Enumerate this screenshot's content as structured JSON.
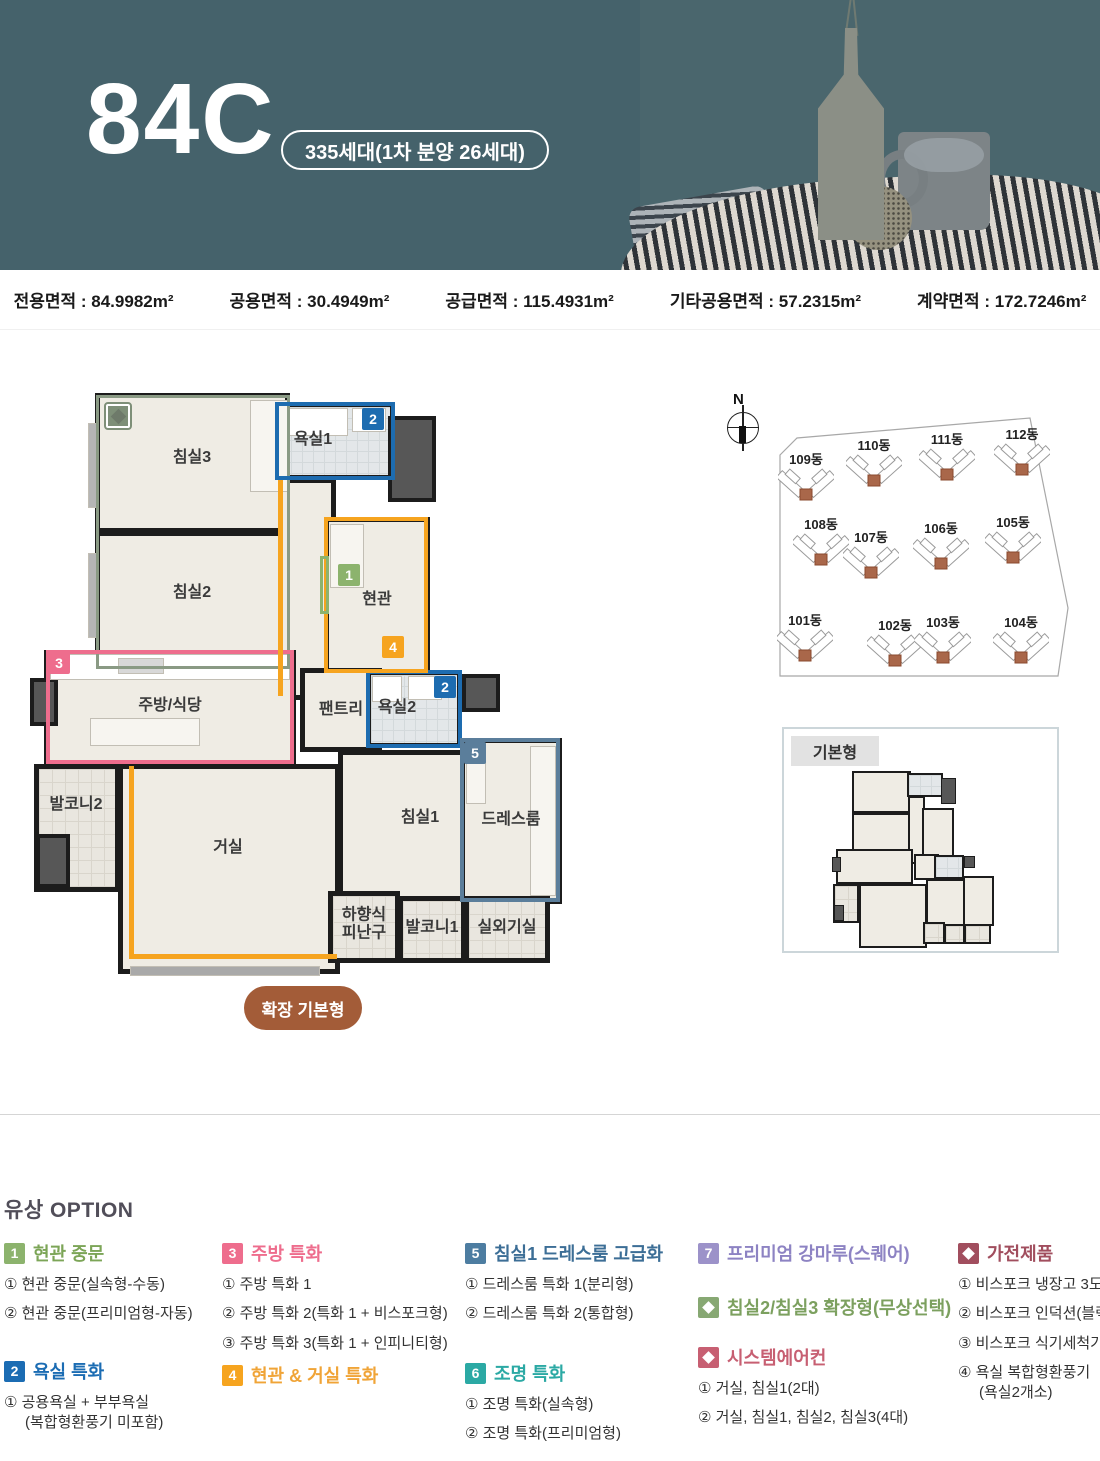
{
  "header": {
    "unit_type": "84C",
    "badge": "335세대(1차 분양 26세대)",
    "bg_color": "#45626b"
  },
  "area_bar": {
    "items": [
      {
        "label": "전용면적",
        "value": "84.9982m²"
      },
      {
        "label": "공용면적",
        "value": "30.4949m²"
      },
      {
        "label": "공급면적",
        "value": "115.4931m²"
      },
      {
        "label": "기타공용면적",
        "value": "57.2315m²"
      },
      {
        "label": "계약면적",
        "value": "172.7246m²"
      }
    ]
  },
  "floor_plan": {
    "expand_button": "확장 기본형",
    "wall_color": "#1c1c1c",
    "floor_color": "#efece4",
    "rooms": [
      {
        "key": "bedroom3",
        "x": 65,
        "y": 5,
        "w": 195,
        "h": 140,
        "type": "floor"
      },
      {
        "key": "bath1",
        "x": 245,
        "y": 14,
        "w": 120,
        "h": 78,
        "type": "bath"
      },
      {
        "key": "bedroom2",
        "x": 65,
        "y": 143,
        "w": 195,
        "h": 137,
        "type": "floor"
      },
      {
        "key": "corridor",
        "x": 248,
        "y": 90,
        "w": 58,
        "h": 222,
        "type": "floor"
      },
      {
        "key": "entrance",
        "x": 294,
        "y": 129,
        "w": 106,
        "h": 158,
        "type": "floor"
      },
      {
        "key": "kitchen",
        "x": 14,
        "y": 262,
        "w": 252,
        "h": 116,
        "type": "floor"
      },
      {
        "key": "pantry",
        "x": 270,
        "y": 280,
        "w": 82,
        "h": 84,
        "type": "floor"
      },
      {
        "key": "bath2",
        "x": 336,
        "y": 282,
        "w": 96,
        "h": 78,
        "type": "bath"
      },
      {
        "key": "balcony2",
        "x": 4,
        "y": 376,
        "w": 86,
        "h": 128,
        "type": "tile"
      },
      {
        "key": "living",
        "x": 88,
        "y": 376,
        "w": 222,
        "h": 210,
        "type": "floor"
      },
      {
        "key": "bedroom1",
        "x": 308,
        "y": 362,
        "w": 164,
        "h": 167,
        "type": "floor"
      },
      {
        "key": "dressroom",
        "x": 430,
        "y": 350,
        "w": 102,
        "h": 166,
        "type": "floor"
      },
      {
        "key": "escape",
        "x": 298,
        "y": 503,
        "w": 72,
        "h": 72,
        "type": "tile"
      },
      {
        "key": "balcony1",
        "x": 368,
        "y": 508,
        "w": 68,
        "h": 67,
        "type": "tile"
      },
      {
        "key": "outdoor",
        "x": 434,
        "y": 508,
        "w": 86,
        "h": 67,
        "type": "tile"
      }
    ],
    "dark_blocks": [
      {
        "x": 358,
        "y": 28,
        "w": 48,
        "h": 86
      },
      {
        "x": 432,
        "y": 286,
        "w": 38,
        "h": 38
      },
      {
        "x": 0,
        "y": 290,
        "w": 28,
        "h": 48
      },
      {
        "x": 6,
        "y": 446,
        "w": 34,
        "h": 54
      }
    ],
    "fixtures": [
      {
        "x": 20,
        "y": 266,
        "w": 240,
        "h": 26,
        "c": "#ffffff"
      },
      {
        "x": 88,
        "y": 270,
        "w": 46,
        "h": 16,
        "c": "#d8d8d8"
      },
      {
        "x": 60,
        "y": 330,
        "w": 110,
        "h": 28,
        "c": "#f7f5f0"
      },
      {
        "x": 252,
        "y": 20,
        "w": 66,
        "h": 28,
        "c": "#ffffff"
      },
      {
        "x": 322,
        "y": 20,
        "w": 34,
        "h": 24,
        "c": "#ffffff"
      },
      {
        "x": 342,
        "y": 288,
        "w": 30,
        "h": 26,
        "c": "#ffffff"
      },
      {
        "x": 378,
        "y": 288,
        "w": 34,
        "h": 24,
        "c": "#ffffff"
      },
      {
        "x": 220,
        "y": 12,
        "w": 38,
        "h": 92,
        "c": "#f7f5f0"
      },
      {
        "x": 500,
        "y": 358,
        "w": 26,
        "h": 150,
        "c": "#f7f5f0"
      },
      {
        "x": 436,
        "y": 356,
        "w": 20,
        "h": 60,
        "c": "#f7f5f0"
      },
      {
        "x": 300,
        "y": 136,
        "w": 34,
        "h": 64,
        "c": "#f7f5f0"
      },
      {
        "x": 58,
        "y": 35,
        "w": 9,
        "h": 85,
        "c": "#b5b5b5"
      },
      {
        "x": 58,
        "y": 165,
        "w": 9,
        "h": 85,
        "c": "#b5b5b5"
      },
      {
        "x": 100,
        "y": 578,
        "w": 190,
        "h": 10,
        "c": "#a9a9a9"
      }
    ],
    "overlays": [
      {
        "x": 66,
        "y": 7,
        "w": 194,
        "h": 274,
        "color": "#8a9a84",
        "bw": 3
      },
      {
        "x": 245,
        "y": 14,
        "w": 120,
        "h": 78,
        "color": "#1d6cb0",
        "bw": 4
      },
      {
        "x": 336,
        "y": 282,
        "w": 96,
        "h": 78,
        "color": "#1d6cb0",
        "bw": 4
      },
      {
        "x": 16,
        "y": 262,
        "w": 248,
        "h": 114,
        "color": "#ee6d8d",
        "bw": 4
      },
      {
        "x": 294,
        "y": 129,
        "w": 104,
        "h": 156,
        "color": "#f6a41f",
        "bw": 4
      },
      {
        "x": 430,
        "y": 350,
        "w": 100,
        "h": 164,
        "color": "#5b7e9b",
        "bw": 4
      },
      {
        "x": 290,
        "y": 168,
        "w": 9,
        "h": 58,
        "color": "#8db36e",
        "bw": 3
      }
    ],
    "orange_lines": [
      {
        "x": 248,
        "y": 92,
        "w": 5,
        "h": 216
      },
      {
        "x": 99,
        "y": 378,
        "w": 5,
        "h": 192
      },
      {
        "x": 99,
        "y": 566,
        "w": 208,
        "h": 5
      }
    ],
    "labels": [
      {
        "text": "침실3",
        "x": 162,
        "y": 70
      },
      {
        "text": "욕실1",
        "x": 283,
        "y": 52
      },
      {
        "text": "침실2",
        "x": 162,
        "y": 205
      },
      {
        "text": "현관",
        "x": 347,
        "y": 212
      },
      {
        "text": "주방/식당",
        "x": 140,
        "y": 318
      },
      {
        "text": "팬트리",
        "x": 311,
        "y": 322
      },
      {
        "text": "욕실2",
        "x": 367,
        "y": 320
      },
      {
        "text": "발코니2",
        "x": 46,
        "y": 417
      },
      {
        "text": "거실",
        "x": 198,
        "y": 460
      },
      {
        "text": "침실1",
        "x": 390,
        "y": 430
      },
      {
        "text": "드레스룸",
        "x": 481,
        "y": 432
      },
      {
        "text": "하향식\n피난구",
        "x": 334,
        "y": 537
      },
      {
        "text": "발코니1",
        "x": 402,
        "y": 540
      },
      {
        "text": "실외기실",
        "x": 477,
        "y": 540
      }
    ],
    "badges": [
      {
        "n": "2",
        "x": 332,
        "y": 20,
        "color": "#1d6cb0"
      },
      {
        "n": "1",
        "x": 308,
        "y": 176,
        "color": "#8cb36d"
      },
      {
        "n": "4",
        "x": 352,
        "y": 248,
        "color": "#f6a41f"
      },
      {
        "n": "3",
        "x": 18,
        "y": 264,
        "color": "#ee6d8d"
      },
      {
        "n": "2",
        "x": 404,
        "y": 288,
        "color": "#1d6cb0"
      },
      {
        "n": "5",
        "x": 434,
        "y": 354,
        "color": "#5b7e9b"
      }
    ],
    "marker": {
      "x": 76,
      "y": 16,
      "size": 24,
      "color": "#7e8f78"
    }
  },
  "site_plan": {
    "compass": "N",
    "boundary_points": "80,62 97,45 330,25 368,215 358,283 80,283",
    "unit_color": "#a9674a",
    "buildings": [
      {
        "name": "109동",
        "x": 106,
        "y": 56
      },
      {
        "name": "110동",
        "x": 174,
        "y": 42
      },
      {
        "name": "111동",
        "x": 247,
        "y": 36
      },
      {
        "name": "112동",
        "x": 322,
        "y": 31
      },
      {
        "name": "108동",
        "x": 121,
        "y": 121
      },
      {
        "name": "107동",
        "x": 171,
        "y": 134
      },
      {
        "name": "106동",
        "x": 241,
        "y": 125
      },
      {
        "name": "105동",
        "x": 313,
        "y": 119
      },
      {
        "name": "101동",
        "x": 105,
        "y": 217
      },
      {
        "name": "102동",
        "x": 195,
        "y": 222
      },
      {
        "name": "103동",
        "x": 243,
        "y": 219
      },
      {
        "name": "104동",
        "x": 321,
        "y": 219
      }
    ]
  },
  "basic_plan": {
    "label": "기본형"
  },
  "options": {
    "title": "유상 OPTION",
    "columns": [
      {
        "left": 4,
        "sections": [
          {
            "top": 0,
            "badge": "1",
            "badge_type": "number",
            "color": "#8cb36d",
            "title_color": "#7ca557",
            "title": "현관 중문",
            "items": [
              {
                "text": "① 현관 중문(실속형-수동)"
              },
              {
                "text": "② 현관 중문(프리미엄형-자동)"
              }
            ]
          },
          {
            "top": 118,
            "badge": "2",
            "badge_type": "number",
            "color": "#1b6cb3",
            "title_color": "#1b6cb3",
            "title": "욕실 특화",
            "items": [
              {
                "text": "① 공용욕실 + 부부욕실",
                "sub": "(복합형환풍기 미포함)"
              }
            ]
          }
        ]
      },
      {
        "left": 222,
        "sections": [
          {
            "top": 0,
            "badge": "3",
            "badge_type": "number",
            "color": "#ee6d8d",
            "title_color": "#ee6d8d",
            "title": "주방 특화",
            "items": [
              {
                "text": "① 주방 특화 1"
              },
              {
                "text": "② 주방 특화 2(특화 1 + 비스포크형)"
              },
              {
                "text": "③ 주방 특화 3(특화 1 + 인피니티형)"
              }
            ]
          },
          {
            "top": 122,
            "badge": "4",
            "badge_type": "number",
            "color": "#f6a41f",
            "title_color": "#f0a437",
            "title": "현관 & 거실 특화",
            "items": []
          }
        ]
      },
      {
        "left": 465,
        "sections": [
          {
            "top": 0,
            "badge": "5",
            "badge_type": "number",
            "color": "#4d7da1",
            "title_color": "#3c6e96",
            "title": "침실1 드레스룸 고급화",
            "items": [
              {
                "text": "① 드레스룸 특화 1(분리형)"
              },
              {
                "text": "② 드레스룸 특화 2(통합형)"
              }
            ]
          },
          {
            "top": 120,
            "badge": "6",
            "badge_type": "number",
            "color": "#2ba9a4",
            "title_color": "#2ba9a4",
            "title": "조명 특화",
            "items": [
              {
                "text": "① 조명 특화(실속형)"
              },
              {
                "text": "② 조명 특화(프리미엄형)"
              }
            ]
          }
        ]
      },
      {
        "left": 698,
        "sections": [
          {
            "top": 0,
            "badge": "7",
            "badge_type": "number",
            "color": "#9c92c9",
            "title_color": "#8d83c3",
            "title": "프리미엄 강마루(스퀘어)",
            "items": []
          },
          {
            "top": 54,
            "badge": "",
            "badge_type": "diamond",
            "color": "#87a873",
            "title_color": "#7ca05f",
            "title": "침실2/침실3 확장형(무상선택)",
            "items": []
          },
          {
            "top": 104,
            "badge": "",
            "badge_type": "diamond",
            "color": "#c75f72",
            "title_color": "#c75f72",
            "title": "시스템에어컨",
            "items": [
              {
                "text": "① 거실, 침실1(2대)"
              },
              {
                "text": "② 거실, 침실1, 침실2, 침실3(4대)"
              }
            ]
          }
        ]
      },
      {
        "left": 958,
        "sections": [
          {
            "top": 0,
            "badge": "",
            "badge_type": "diamond",
            "color": "#a14e5e",
            "title_color": "#a14e5e",
            "title": "가전제품",
            "items": [
              {
                "text": "① 비스포크 냉장고 3도어"
              },
              {
                "text": "② 비스포크 인덕션(블랙)"
              },
              {
                "text": "③ 비스포크 식기세척기"
              },
              {
                "text": "④ 욕실 복합형환풍기",
                "sub": "(욕실2개소)"
              }
            ]
          }
        ]
      }
    ]
  }
}
